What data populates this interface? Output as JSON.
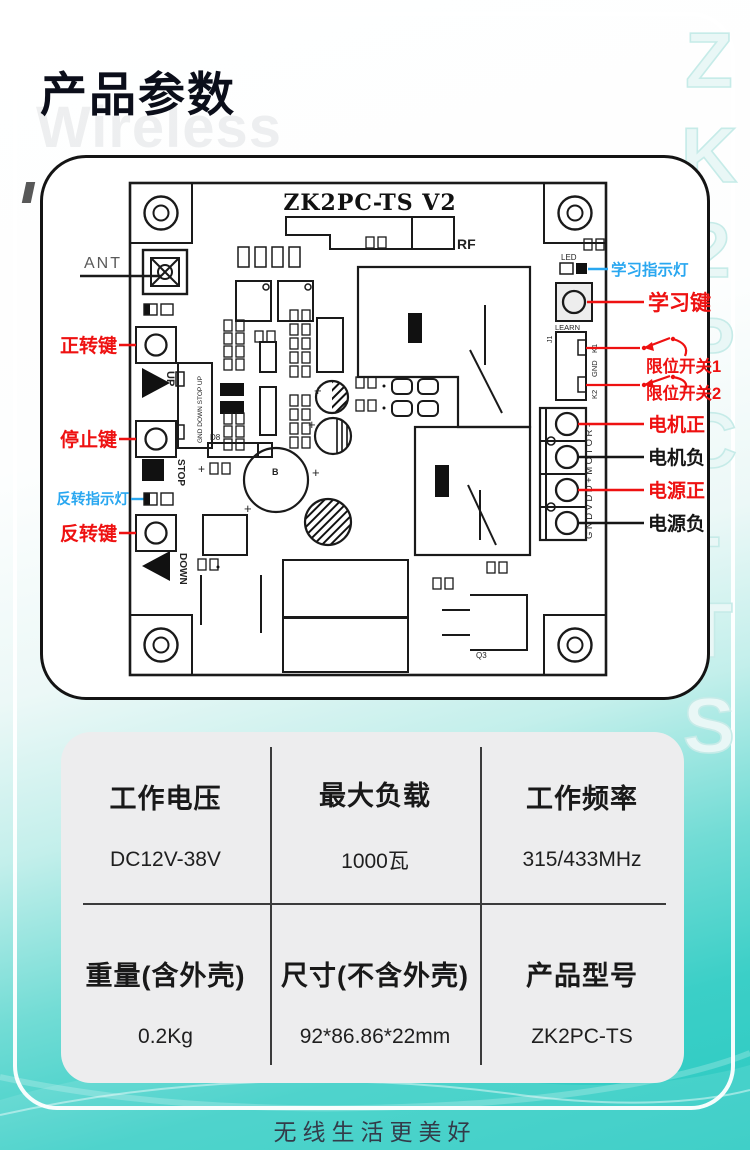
{
  "colors": {
    "accent_red": "#ee1111",
    "accent_blue": "#29a7f0",
    "teal": "#2bcac2",
    "table_bg": "#ededee",
    "line": "#1a1a1a"
  },
  "header": {
    "title": "产品参数",
    "watermark": "Wireless",
    "side_vertical_text": "ZK2PC-TS"
  },
  "board": {
    "title": "ZK2PC-TS V2",
    "silkscreen": {
      "rf": "RF",
      "ant": "ANT",
      "led": "LED",
      "learn": "LEARN",
      "j1": "J1",
      "k1": "K1",
      "gnd": "GND",
      "k2": "K2",
      "up": "UP",
      "stop": "STOP",
      "down": "DOWN",
      "header_pins": "GND DOWN STOP UP",
      "terminal_pins": "GNDVDD+MOTOR-",
      "b": "B",
      "d8": "D8",
      "q3": "Q3",
      "plus": "+"
    },
    "callouts": {
      "forward_key": "正转键",
      "stop_key": "停止键",
      "reverse_indicator": "反转指示灯",
      "reverse_key": "反转键",
      "learn_indicator": "学习指示灯",
      "learn_key": "学习键",
      "limit_switch_1": "限位开关1",
      "limit_switch_2": "限位开关2",
      "motor_positive": "电机正",
      "motor_negative": "电机负",
      "power_positive": "电源正",
      "power_negative": "电源负"
    }
  },
  "specs": {
    "rows": [
      [
        {
          "name": "工作电压",
          "value": "DC12V-38V"
        },
        {
          "name": "最大负载",
          "value": "1000瓦"
        },
        {
          "name": "工作频率",
          "value": "315/433MHz"
        }
      ],
      [
        {
          "name": "重量(含外壳)",
          "value": "0.2Kg"
        },
        {
          "name": "尺寸(不含外壳)",
          "value": "92*86.86*22mm"
        },
        {
          "name": "产品型号",
          "value": "ZK2PC-TS"
        }
      ]
    ]
  },
  "footer": {
    "slogan": "无线生活更美好"
  }
}
